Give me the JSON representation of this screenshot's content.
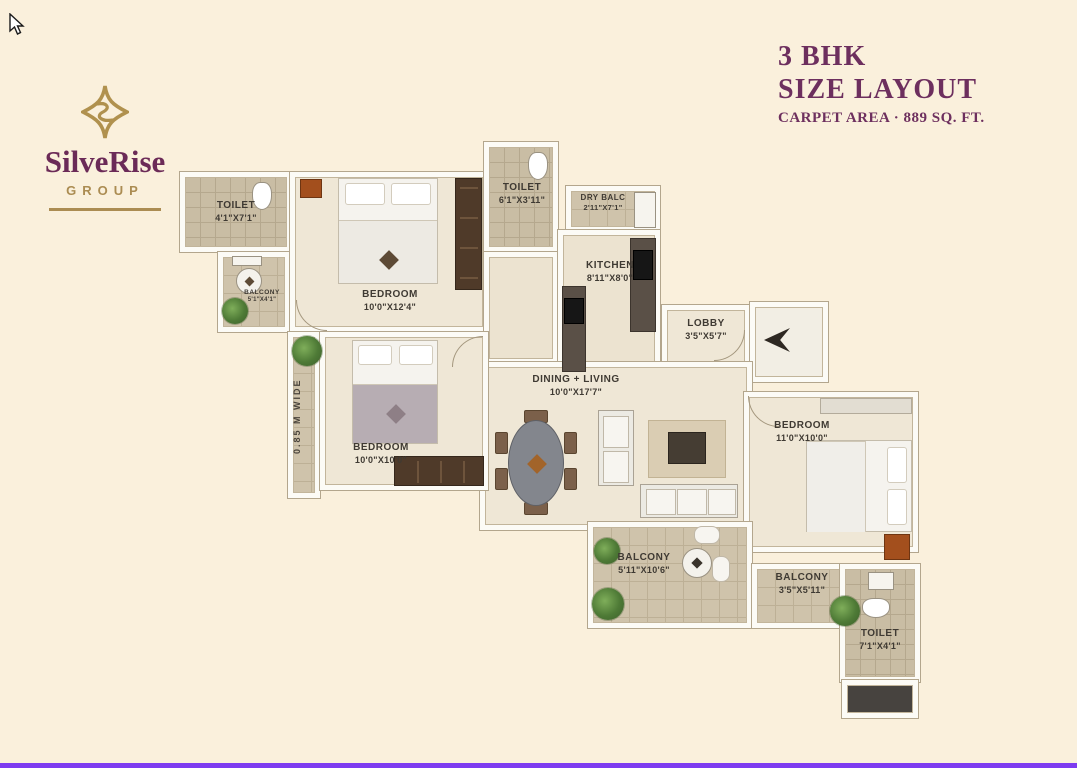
{
  "page": {
    "background": "#faf0dc",
    "bottom_bar_color": "#7d3bf0",
    "accent_purple": "#6d2f5e",
    "brand_gold": "#ab8c52"
  },
  "logo": {
    "name": "SilveRise",
    "subtitle": "GROUP"
  },
  "title": {
    "line1": "3 BHK",
    "line2": "SIZE LAYOUT",
    "line3": "CARPET AREA · 889 SQ. FT."
  },
  "rooms": {
    "toilet1": {
      "label": "TOILET",
      "dims": "4'1\"X7'1\""
    },
    "balcony_small": {
      "label": "BALCONY",
      "dims": "5'1\"X4'1\""
    },
    "bedroom1": {
      "label": "BEDROOM",
      "dims": "10'0\"X12'4\""
    },
    "toilet2": {
      "label": "TOILET",
      "dims": "6'1\"X3'11\""
    },
    "dry_balc": {
      "label": "DRY BALC",
      "dims": "2'11\"X7'1\""
    },
    "kitchen": {
      "label": "KITCHEN",
      "dims": "8'11\"X8'0\""
    },
    "lobby": {
      "label": "LOBBY",
      "dims": "3'5\"X5'7\""
    },
    "dining_living": {
      "label": "DINING + LIVING",
      "dims": "10'0\"X17'7\""
    },
    "bedroom2": {
      "label": "BEDROOM",
      "dims": "10'0\"X10'0\""
    },
    "bedroom3": {
      "label": "BEDROOM",
      "dims": "11'0\"X10'0\""
    },
    "balcony1": {
      "label": "BALCONY",
      "dims": "5'11\"X10'6\""
    },
    "balcony2": {
      "label": "BALCONY",
      "dims": "3'5\"X5'11\""
    },
    "toilet3": {
      "label": "TOILET",
      "dims": "7'1\"X4'1\""
    },
    "passage": {
      "note": "0.85 M WIDE"
    }
  }
}
